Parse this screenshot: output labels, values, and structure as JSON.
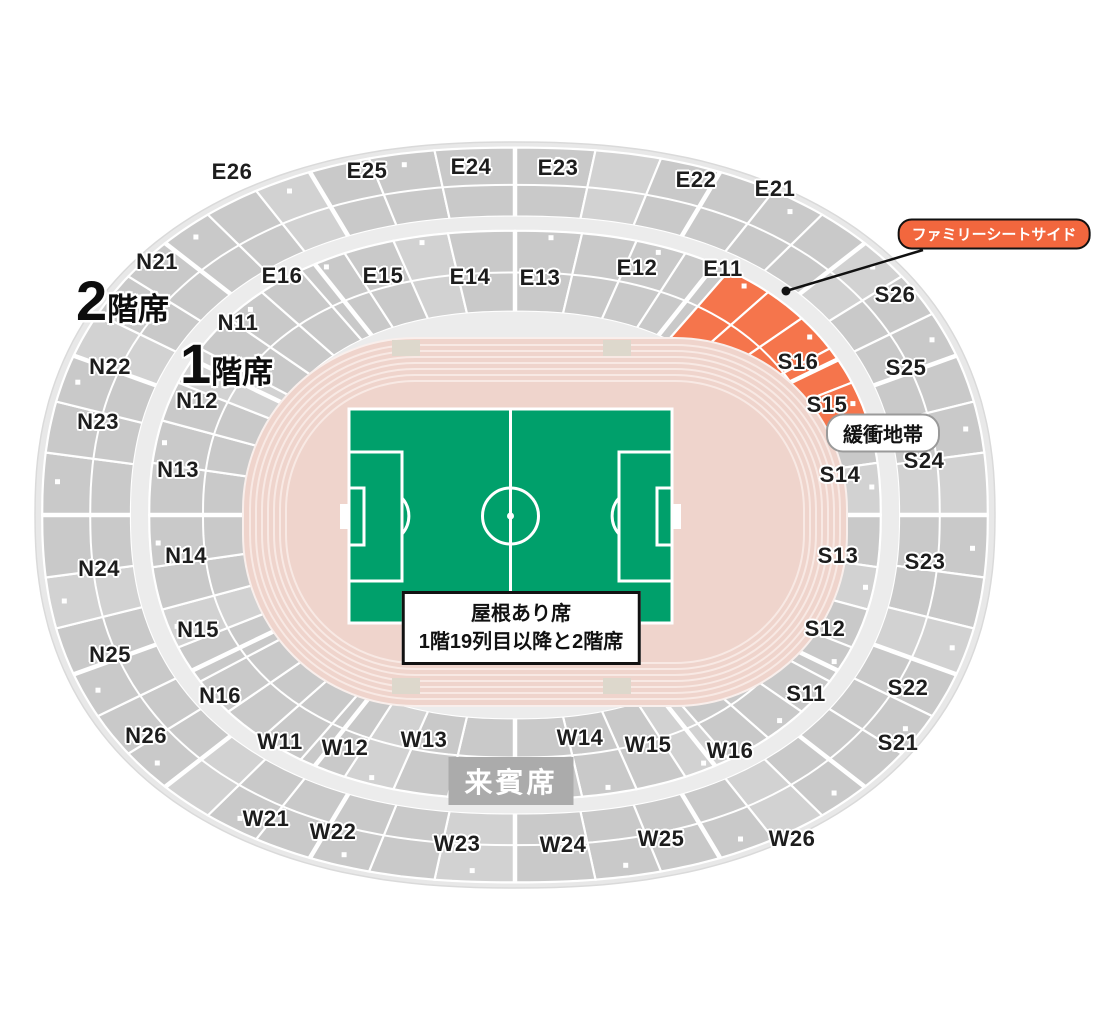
{
  "colors": {
    "highlight_orange": "#f5754c",
    "callout_orange": "#f2673e",
    "field_green": "#00a06b",
    "track_pink": "#efd4cc",
    "track_lane": "#f8e9e4",
    "seat_gray": "#c9c9c9",
    "seat_gray_alt": "#d2d2d2",
    "walkway_gray": "#ececec",
    "vip_gray": "#ababab"
  },
  "tier_labels": [
    {
      "num": "2",
      "suffix": "階席",
      "x": 76,
      "y": 301
    },
    {
      "num": "1",
      "suffix": "階席",
      "x": 180,
      "y": 364
    }
  ],
  "section_groups": [
    {
      "name": "east-tier2",
      "items": [
        {
          "label": "E26",
          "x": 232,
          "y": 172
        },
        {
          "label": "E25",
          "x": 367,
          "y": 171
        },
        {
          "label": "E24",
          "x": 471,
          "y": 167
        },
        {
          "label": "E23",
          "x": 558,
          "y": 168
        },
        {
          "label": "E22",
          "x": 696,
          "y": 180
        },
        {
          "label": "E21",
          "x": 775,
          "y": 189
        }
      ]
    },
    {
      "name": "east-tier1",
      "items": [
        {
          "label": "E16",
          "x": 282,
          "y": 276
        },
        {
          "label": "E15",
          "x": 383,
          "y": 276
        },
        {
          "label": "E14",
          "x": 470,
          "y": 277
        },
        {
          "label": "E13",
          "x": 540,
          "y": 278
        },
        {
          "label": "E12",
          "x": 637,
          "y": 268
        },
        {
          "label": "E11",
          "x": 723,
          "y": 269
        }
      ]
    },
    {
      "name": "north-tier2",
      "items": [
        {
          "label": "N21",
          "x": 157,
          "y": 262
        },
        {
          "label": "N22",
          "x": 110,
          "y": 367
        },
        {
          "label": "N23",
          "x": 98,
          "y": 422
        },
        {
          "label": "N24",
          "x": 99,
          "y": 569
        },
        {
          "label": "N25",
          "x": 110,
          "y": 655
        },
        {
          "label": "N26",
          "x": 146,
          "y": 736
        }
      ]
    },
    {
      "name": "north-tier1",
      "items": [
        {
          "label": "N11",
          "x": 238,
          "y": 323
        },
        {
          "label": "N12",
          "x": 197,
          "y": 401
        },
        {
          "label": "N13",
          "x": 178,
          "y": 470
        },
        {
          "label": "N14",
          "x": 186,
          "y": 556
        },
        {
          "label": "N15",
          "x": 198,
          "y": 630
        },
        {
          "label": "N16",
          "x": 220,
          "y": 696
        }
      ]
    },
    {
      "name": "south-tier2",
      "items": [
        {
          "label": "S26",
          "x": 895,
          "y": 295
        },
        {
          "label": "S25",
          "x": 906,
          "y": 368
        },
        {
          "label": "S24",
          "x": 924,
          "y": 461
        },
        {
          "label": "S23",
          "x": 925,
          "y": 562
        },
        {
          "label": "S22",
          "x": 908,
          "y": 688
        },
        {
          "label": "S21",
          "x": 898,
          "y": 743
        }
      ]
    },
    {
      "name": "south-tier1",
      "items": [
        {
          "label": "S16",
          "x": 798,
          "y": 362
        },
        {
          "label": "S15",
          "x": 827,
          "y": 405
        },
        {
          "label": "S14",
          "x": 840,
          "y": 475
        },
        {
          "label": "S13",
          "x": 838,
          "y": 556
        },
        {
          "label": "S12",
          "x": 825,
          "y": 629
        },
        {
          "label": "S11",
          "x": 806,
          "y": 694
        }
      ]
    },
    {
      "name": "west-tier1",
      "items": [
        {
          "label": "W11",
          "x": 280,
          "y": 742
        },
        {
          "label": "W12",
          "x": 345,
          "y": 748
        },
        {
          "label": "W13",
          "x": 424,
          "y": 740
        },
        {
          "label": "W14",
          "x": 580,
          "y": 738
        },
        {
          "label": "W15",
          "x": 648,
          "y": 745
        },
        {
          "label": "W16",
          "x": 730,
          "y": 751
        }
      ]
    },
    {
      "name": "west-tier2",
      "items": [
        {
          "label": "W21",
          "x": 266,
          "y": 819
        },
        {
          "label": "W22",
          "x": 333,
          "y": 832
        },
        {
          "label": "W23",
          "x": 457,
          "y": 844
        },
        {
          "label": "W24",
          "x": 563,
          "y": 845
        },
        {
          "label": "W25",
          "x": 661,
          "y": 839
        },
        {
          "label": "W26",
          "x": 792,
          "y": 839
        }
      ]
    }
  ],
  "callout": {
    "label": "ファミリーシートサイド",
    "cx": 994,
    "cy": 234,
    "line": {
      "x1": 923,
      "y1": 250,
      "x2": 786,
      "y2": 291
    }
  },
  "buffer_zone": {
    "label": "緩衝地帯",
    "cx": 883,
    "cy": 433
  },
  "roof_note": {
    "lines": [
      "屋根あり席",
      "1階19列目以降と2階席"
    ],
    "cx": 521,
    "cy": 628
  },
  "vip_box": {
    "label": "来賓席",
    "cx": 511,
    "cy": 781
  }
}
